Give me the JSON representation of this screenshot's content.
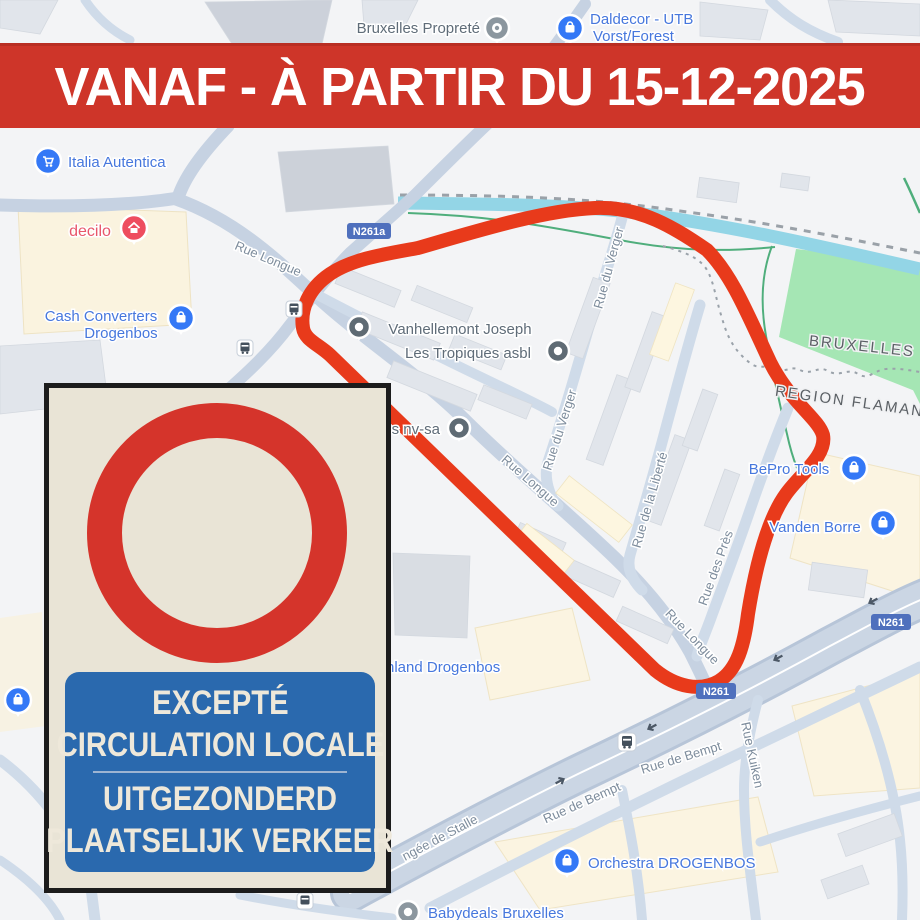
{
  "banner": {
    "text": "VANAF - À PARTIR DU 15-12-2025"
  },
  "sign": {
    "line1": "EXCEPTÉ",
    "line2": "CIRCULATION LOCALE",
    "line3": "UITGEZONDERD",
    "line4": "PLAATSELIJK VERKEER"
  },
  "map": {
    "labels": {
      "bruxelles_proprete": "Bruxelles Propreté",
      "daldecor_line1": "Daldecor - UTB",
      "daldecor_line2": "Vorst/Forest",
      "italia": "Italia Autentica",
      "decilo": "decilo",
      "cash_line1": "Cash Converters",
      "cash_line2": "Drogenbos",
      "rue_longue": "Rue Longue",
      "vanhellemont": "Vanhellemont Joseph",
      "tropiques": "Les Tropiques asbl",
      "rue_du_verger": "Rue du Verger",
      "s_nv_sa": "s nv-sa",
      "bruxelles": "BRUXELLES",
      "region_flamande": "REGION FLAMAND",
      "bepro": "BePro Tools",
      "vanden_borre": "Vanden Borre",
      "rue_liberte": "Rue de la Liberté",
      "rue_des_pres": "Rue des Près",
      "hland": "hland Drogenbos",
      "rue_kuiken": "Rue Kuiken",
      "rue_bempt": "Rue de Bempt",
      "ngee_stalle": "ngée de Stalle",
      "orchestra": "Orchestra DROGENBOS",
      "babydeals": "Babydeals Bruxelles",
      "n261a": "N261a",
      "n261": "N261"
    },
    "colors": {
      "banner_red": "#ce3529",
      "route_red": "#e83a1b",
      "ring_red": "#d5342b",
      "panel_blue": "#2a69ae",
      "store_pin_blue": "#3478f6",
      "decilo_pin_red": "#ee4d5f",
      "park_green": "#a5e6b4",
      "river_cyan": "#93d5e6",
      "badge_blue": "#4f70bd"
    }
  }
}
